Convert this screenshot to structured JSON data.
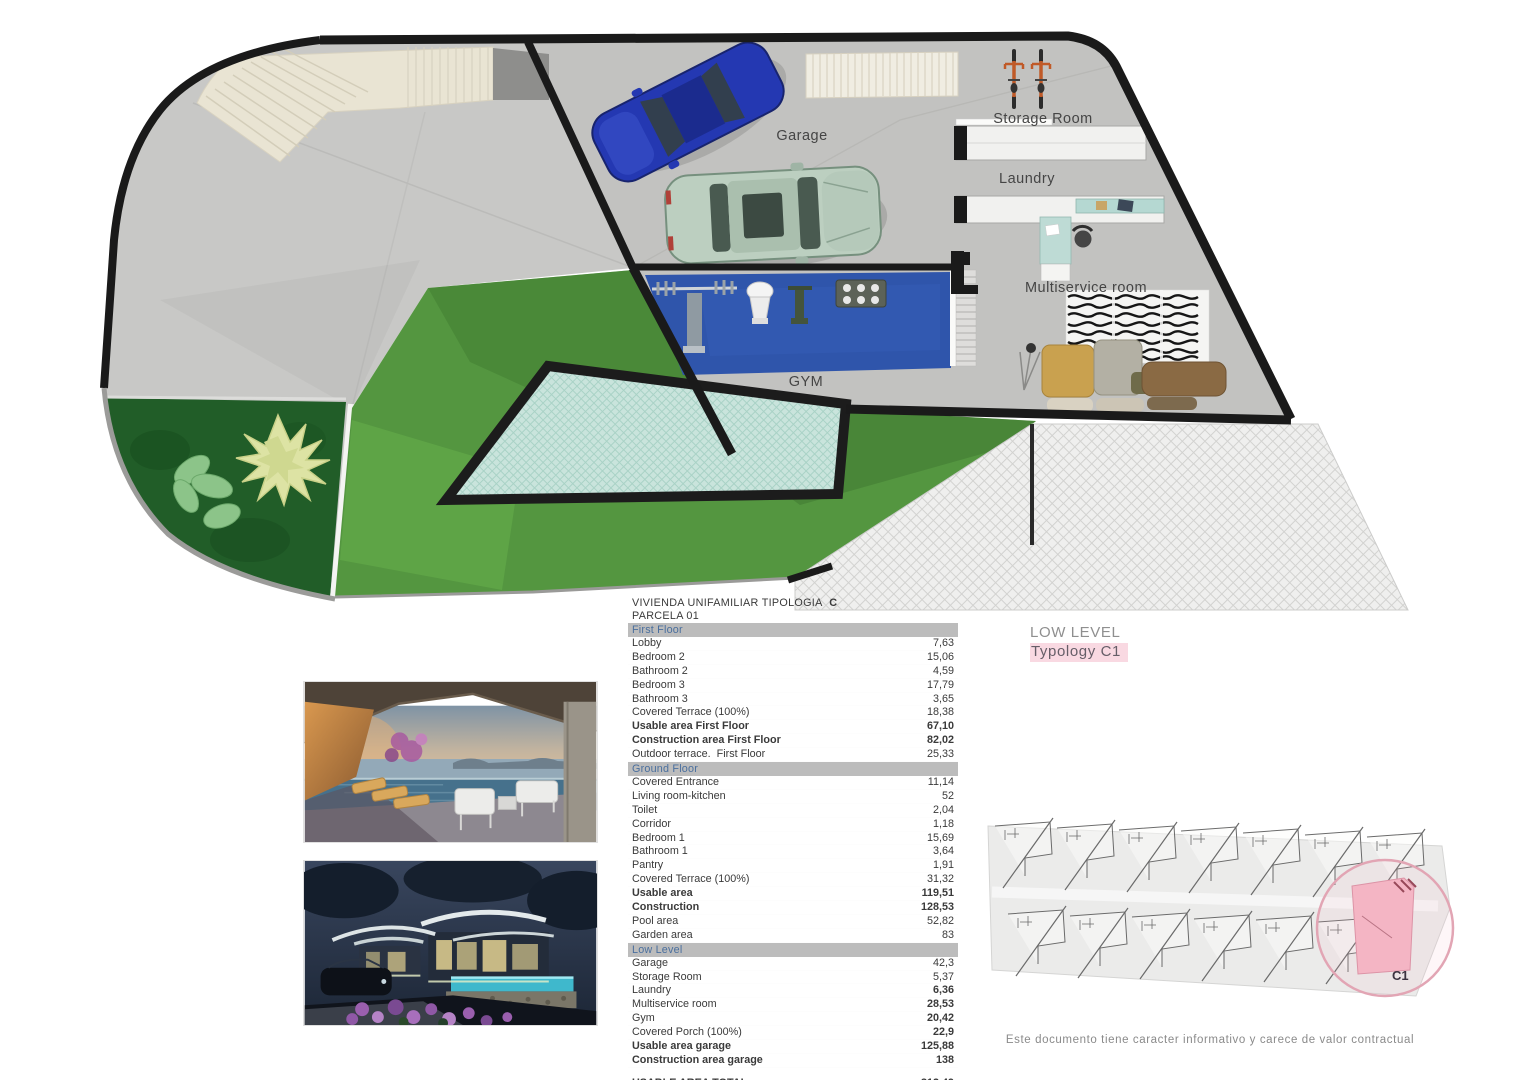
{
  "plan": {
    "labels": {
      "garage": "Garage",
      "storage": "Storage Room",
      "laundry": "Laundry",
      "multiservice": "Multiservice room",
      "gym": "GYM"
    }
  },
  "table": {
    "title_prefix": "VIVIENDA UNIFAMILIAR TIPOLOGIA",
    "title_bold": "C",
    "subtitle": "PARCELA  01",
    "sections": [
      {
        "header": "First Floor",
        "rows": [
          {
            "label": "Lobby",
            "value": "7,63"
          },
          {
            "label": "Bedroom 2",
            "value": "15,06"
          },
          {
            "label": "Bathroom 2",
            "value": "4,59"
          },
          {
            "label": "Bedroom 3",
            "value": "17,79"
          },
          {
            "label": "Bathroom 3",
            "value": "3,65"
          },
          {
            "label": "Covered Terrace (100%)",
            "value": "18,38"
          },
          {
            "label": "Usable area First Floor",
            "value": "67,10",
            "bold": true
          },
          {
            "label": "Construction area First Floor",
            "value": "82,02",
            "bold": true
          },
          {
            "label": "Outdoor terrace.  First Floor",
            "value": "25,33"
          }
        ]
      },
      {
        "header": "Ground Floor",
        "rows": [
          {
            "label": "Covered Entrance",
            "value": "11,14"
          },
          {
            "label": "Living room-kitchen",
            "value": "52"
          },
          {
            "label": "Toilet",
            "value": "2,04"
          },
          {
            "label": "Corridor",
            "value": "1,18"
          },
          {
            "label": "Bedroom 1",
            "value": "15,69"
          },
          {
            "label": "Bathroom 1",
            "value": "3,64"
          },
          {
            "label": "Pantry",
            "value": "1,91"
          },
          {
            "label": "Covered Terrace (100%)",
            "value": "31,32"
          },
          {
            "label": "Usable area",
            "value": "119,51",
            "bold": true
          },
          {
            "label": "Construction",
            "value": "128,53",
            "bold": true
          },
          {
            "label": "Pool area",
            "value": "52,82"
          },
          {
            "label": "Garden area",
            "value": "83"
          }
        ]
      },
      {
        "header": "Low Level",
        "rows": [
          {
            "label": "Garage",
            "value": "42,3"
          },
          {
            "label": "Storage Room",
            "value": "5,37"
          },
          {
            "label": "Laundry",
            "value": "6,36",
            "bold_value": true
          },
          {
            "label": "Multiservice room",
            "value": "28,53",
            "bold_value": true
          },
          {
            "label": "Gym",
            "value": "20,42",
            "bold_value": true
          },
          {
            "label": "Covered Porch (100%)",
            "value": "22,9",
            "bold_value": true
          },
          {
            "label": "Usable area garage",
            "value": "125,88",
            "bold": true
          },
          {
            "label": "Construction area garage",
            "value": "138",
            "bold": true
          }
        ]
      }
    ],
    "totals": [
      {
        "label": "USABLE AREA TOTAL",
        "value": "312,49"
      },
      {
        "label": "CONSTRUCTION AREA TOTAL",
        "value": "348,55"
      }
    ]
  },
  "level_tag": {
    "line1": "LOW LEVEL",
    "line2": "Typology C1"
  },
  "siteplan": {
    "unit_label": "C1"
  },
  "footer": {
    "disclaimer": "Este documento tiene caracter informativo y carece de valor contractual"
  },
  "colors": {
    "accent_pink": "#f9d9e2",
    "band_gray": "#bcbcbc",
    "band_text_blue": "#4a6f9e",
    "lawn_green": "#549640",
    "gym_blue": "#2f55ab",
    "pool_teal": "#c9e4dc",
    "wall_black": "#1a1a1a"
  }
}
